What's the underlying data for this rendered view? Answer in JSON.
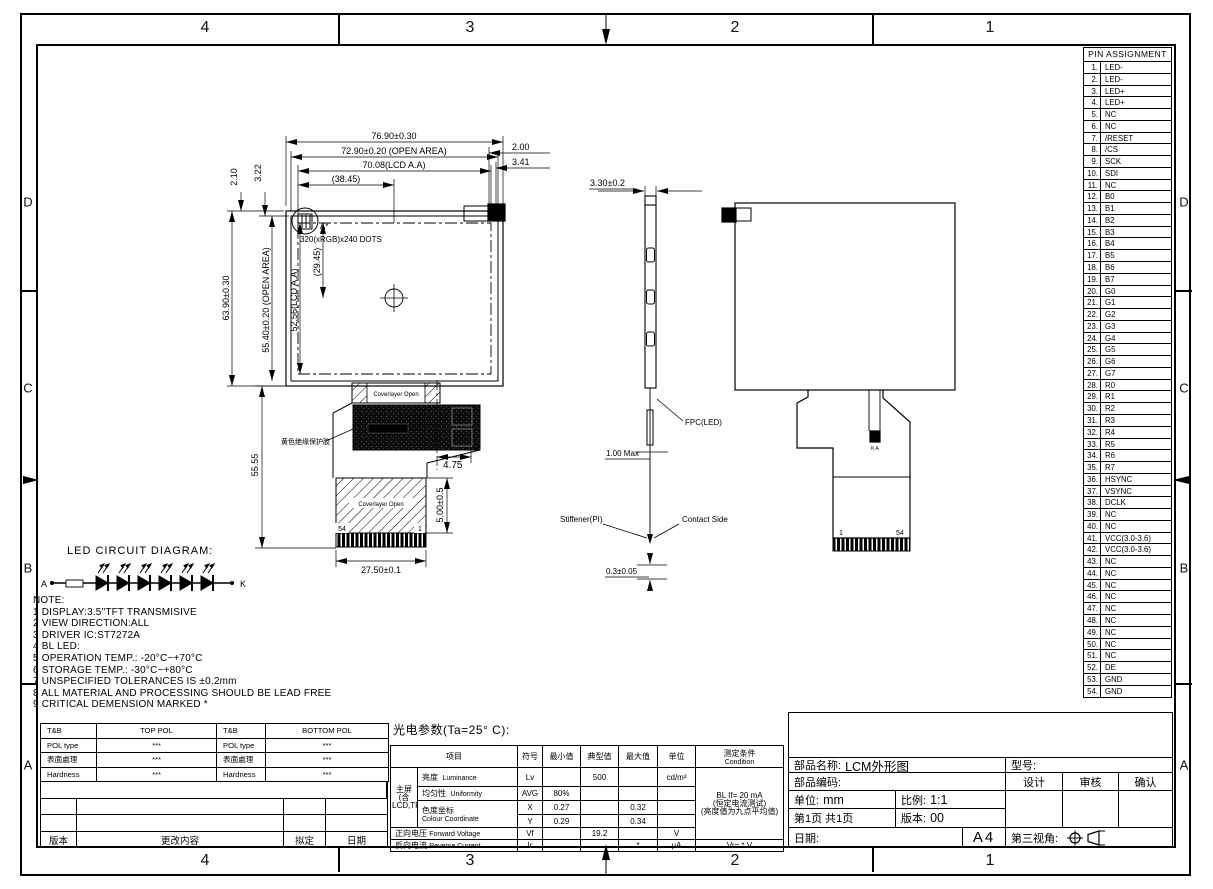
{
  "sheet": {
    "zones_top": [
      "4",
      "3",
      "2",
      "1"
    ],
    "zones_bottom": [
      "4",
      "3",
      "2",
      "1"
    ],
    "zones_left": [
      "D",
      "C",
      "B",
      "A"
    ],
    "zones_right": [
      "D",
      "C",
      "B",
      "A"
    ]
  },
  "pin_table": {
    "title": "PIN ASSIGNMENT",
    "pins": [
      "LED-",
      "LED-",
      "LED+",
      "LED+",
      "NC",
      "NC",
      "/RESET",
      "/CS",
      "SCK",
      "SDI",
      "NC",
      "B0",
      "B1",
      "B2",
      "B3",
      "B4",
      "B5",
      "B6",
      "B7",
      "G0",
      "G1",
      "G2",
      "G3",
      "G4",
      "G5",
      "G6",
      "G7",
      "R0",
      "R1",
      "R2",
      "R3",
      "R4",
      "R5",
      "R6",
      "R7",
      "HSYNC",
      "VSYNC",
      "DCLK",
      "NC",
      "NC",
      "VCC(3.0-3.6)",
      "VCC(3.0-3.6)",
      "NC",
      "NC",
      "NC",
      "NC",
      "NC",
      "NC",
      "NC",
      "NC",
      "NC",
      "DE",
      "GND",
      "GND"
    ]
  },
  "front_view": {
    "dots": "320(xRGB)x240 DOTS",
    "detail": "A*",
    "cover_top": "Coverlayer Open",
    "cover_bottom": "Coverlayer Open",
    "glue": "黄色绝缘保护胶",
    "n54": "54",
    "n1": "1",
    "dims": {
      "w_outline": "76.90±0.30",
      "w_open": "72.90±0.20 (OPEN AREA)",
      "w_aa": "70.08(LCD A.A)",
      "w_half": "(38.45)",
      "r_top": "2.00",
      "r_bottom": "3.41",
      "l_a": "2.10",
      "l_b": "3.22",
      "h_outline": "63.90±0.30",
      "h_open": "55.40±0.20 (OPEN AREA)",
      "h_aa": "52.56(LCD A.A)",
      "h_half": "(29.45)",
      "fpc_len": "55.55",
      "fpc_off": "4.75",
      "contact_len": "5.00±0.5",
      "fpc_width": "27.50±0.1"
    }
  },
  "side_view": {
    "thickness": "3.30±0.2",
    "fpc_label": "FPC(LED)",
    "max_label": "1.00 Max",
    "stiffener_label": "Stiffener(PI)",
    "contact_label": "Contact Side",
    "stiffener_thickness": "0.3±0.05"
  },
  "rear_view": {
    "n1": "1",
    "n54": "54",
    "ka": "K A"
  },
  "led_diagram": {
    "title": "LED CIRCUIT DIAGRAM:",
    "anode": "A",
    "cathode": "K",
    "led_count": 6
  },
  "notes": {
    "title": "NOTE:",
    "items": [
      "1 DISPLAY:3.5\"TFT TRANSMISIVE",
      "2 VIEW DIRECTION:ALL",
      "3 DRIVER IC:ST7272A",
      "4 BL LED:",
      "5 OPERATION TEMP.: -20°C~+70°C",
      "6 STORAGE TEMP.: -30°C~+80°C",
      "7 UNSPECIFIED TOLERANCES IS ±0.2mm",
      "8 ALL MATERIAL AND PROCESSING SHOULD BE LEAD FREE",
      "9 CRITICAL DEMENSION MARKED *"
    ]
  },
  "pol_table": {
    "rows": [
      [
        "T&B",
        "TOP POL",
        "T&B",
        "BOTTOM POL"
      ],
      [
        "POL type",
        "***",
        "POL type",
        "***"
      ],
      [
        "表面處理",
        "***",
        "表面處理",
        "***"
      ],
      [
        "Hardness",
        "***",
        "Hardness",
        "***"
      ]
    ],
    "footer": [
      "版本",
      "更改内容",
      "拟定",
      "日期"
    ]
  },
  "opt_table": {
    "title": "光电参数(Ta=25° C):",
    "headers": {
      "item": "项目",
      "sym": "符号",
      "min": "最小值",
      "typ": "典型值",
      "max": "最大值",
      "unit": "单位",
      "cond": "测定条件",
      "cond_en": "Condition"
    },
    "group_lines": [
      "主屏",
      "(含",
      "LCD,TP)"
    ],
    "luminance": {
      "name": "亮度",
      "name_en": "Luminance",
      "sym": "Lv",
      "typ": "500",
      "unit": "cd/m²"
    },
    "uniformity": {
      "name": "均匀性",
      "name_en": "Uniformity",
      "sym": "AVG",
      "min": "80%"
    },
    "chromaticity": {
      "name": "色度坐标",
      "name_en": "Colour Coordinate",
      "x_sym": "X",
      "x_min": "0.27",
      "x_max": "0.32",
      "y_sym": "Y",
      "y_min": "0.29",
      "y_max": "0.34"
    },
    "forward_voltage": {
      "name": "正向电压",
      "name_en": "Forward Voltage",
      "sym": "Vf",
      "typ": "19.2",
      "unit": "V"
    },
    "reverse_current": {
      "name": "反向电流",
      "name_en": "Reverse Current",
      "sym": "Ir",
      "max": "*",
      "unit": "μA",
      "cond": "Vr= * V"
    },
    "cond_lines": [
      "BL If= 20 mA",
      "(恒定电流测试)",
      "(亮度值为九点平均值)"
    ]
  },
  "title_block": {
    "part_name_label": "部品名称:",
    "part_name": "LCM外形图",
    "model_label": "型号:",
    "part_code_label": "部品编码:",
    "design": "设计",
    "review": "审核",
    "confirm": "确认",
    "unit_label": "单位:",
    "unit": "mm",
    "scale_label": "比例:",
    "scale": "1:1",
    "page_label": "第1页 共1页",
    "version_label": "版本:",
    "version": "00",
    "date_label": "日期:",
    "paper": "A4",
    "projection_label": "第三视角:"
  }
}
